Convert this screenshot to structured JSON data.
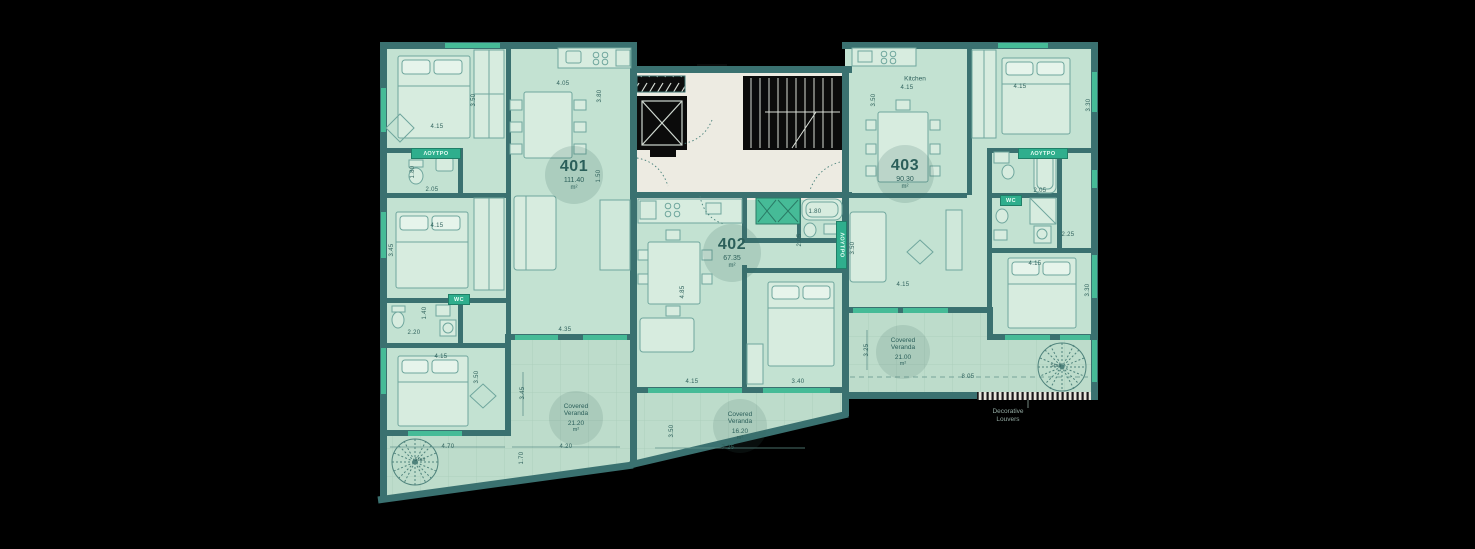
{
  "plan": {
    "units": [
      {
        "number": "401",
        "area": "111.40",
        "area_unit": "m²"
      },
      {
        "number": "402",
        "area": "67.35",
        "area_unit": "m²"
      },
      {
        "number": "403",
        "area": "90.30",
        "area_unit": "m²"
      }
    ],
    "verandas": [
      {
        "line1": "Covered",
        "line2": "Veranda",
        "area": "21.20",
        "area_unit": "m²"
      },
      {
        "line1": "Covered",
        "line2": "Veranda",
        "area": "16.20",
        "area_unit": "m²"
      },
      {
        "line1": "Covered",
        "line2": "Veranda",
        "area": "21.00",
        "area_unit": "m²"
      }
    ],
    "annotation": {
      "line1": "Decorative",
      "line2": "Louvers"
    },
    "room_labels": [
      {
        "text": "Kitchen",
        "x": 915,
        "y": 79
      }
    ],
    "stair_labels": [
      {
        "text": "Stair",
        "x": 420,
        "y": 460
      },
      {
        "text": "Stair",
        "x": 1056,
        "y": 366
      }
    ],
    "fixtures": [
      {
        "text": "ΛΟΥΤΡΟ",
        "x": 411,
        "y": 148,
        "w": 48,
        "h": 9,
        "vertical": false
      },
      {
        "text": "WC",
        "x": 448,
        "y": 294,
        "w": 20,
        "h": 9,
        "vertical": false
      },
      {
        "text": "ΛΟΥΤΡΟ",
        "x": 836,
        "y": 221,
        "w": 9,
        "h": 46,
        "vertical": true
      },
      {
        "text": "ΛΟΥΤΡΟ",
        "x": 1018,
        "y": 148,
        "w": 48,
        "h": 9,
        "vertical": false
      },
      {
        "text": "WC",
        "x": 1000,
        "y": 195,
        "w": 20,
        "h": 9,
        "vertical": false
      }
    ],
    "dimensions": [
      {
        "text": "4.15",
        "x": 437,
        "y": 127,
        "rot": 0
      },
      {
        "text": "3.50",
        "x": 474,
        "y": 100,
        "rot": 90
      },
      {
        "text": "1.80",
        "x": 413,
        "y": 172,
        "rot": 90
      },
      {
        "text": "2.05",
        "x": 432,
        "y": 190,
        "rot": 0
      },
      {
        "text": "4.15",
        "x": 437,
        "y": 226,
        "rot": 0
      },
      {
        "text": "3.45",
        "x": 392,
        "y": 250,
        "rot": 90
      },
      {
        "text": "1.40",
        "x": 425,
        "y": 313,
        "rot": 90
      },
      {
        "text": "2.20",
        "x": 414,
        "y": 333,
        "rot": 0
      },
      {
        "text": "4.15",
        "x": 441,
        "y": 357,
        "rot": 0
      },
      {
        "text": "3.50",
        "x": 477,
        "y": 377,
        "rot": 90
      },
      {
        "text": "4.05",
        "x": 563,
        "y": 84,
        "rot": 0
      },
      {
        "text": "3.80",
        "x": 600,
        "y": 96,
        "rot": 90
      },
      {
        "text": "4.35",
        "x": 565,
        "y": 330,
        "rot": 0
      },
      {
        "text": "1.50",
        "x": 599,
        "y": 176,
        "rot": 90
      },
      {
        "text": "3.45",
        "x": 523,
        "y": 393,
        "rot": 90
      },
      {
        "text": "4.20",
        "x": 566,
        "y": 447,
        "rot": 0
      },
      {
        "text": "1.70",
        "x": 522,
        "y": 458,
        "rot": 90
      },
      {
        "text": "4.70",
        "x": 448,
        "y": 447,
        "rot": 0
      },
      {
        "text": "4.15",
        "x": 692,
        "y": 382,
        "rot": 0
      },
      {
        "text": "3.40",
        "x": 798,
        "y": 382,
        "rot": 0
      },
      {
        "text": "7.25",
        "x": 728,
        "y": 448,
        "rot": 0
      },
      {
        "text": "3.50",
        "x": 672,
        "y": 431,
        "rot": 90
      },
      {
        "text": "4.85",
        "x": 683,
        "y": 292,
        "rot": 90
      },
      {
        "text": "1.80",
        "x": 815,
        "y": 212,
        "rot": 0
      },
      {
        "text": "2.05",
        "x": 800,
        "y": 240,
        "rot": 90
      },
      {
        "text": "4.15",
        "x": 907,
        "y": 88,
        "rot": 0
      },
      {
        "text": "3.50",
        "x": 874,
        "y": 100,
        "rot": 90
      },
      {
        "text": "4.15",
        "x": 1020,
        "y": 87,
        "rot": 0
      },
      {
        "text": "3.30",
        "x": 1089,
        "y": 105,
        "rot": 90
      },
      {
        "text": "2.05",
        "x": 1040,
        "y": 191,
        "rot": 0
      },
      {
        "text": "2.25",
        "x": 1068,
        "y": 235,
        "rot": 0
      },
      {
        "text": "4.15",
        "x": 1035,
        "y": 264,
        "rot": 0
      },
      {
        "text": "3.30",
        "x": 1088,
        "y": 290,
        "rot": 90
      },
      {
        "text": "3.50",
        "x": 853,
        "y": 248,
        "rot": 90
      },
      {
        "text": "4.15",
        "x": 903,
        "y": 285,
        "rot": 0
      },
      {
        "text": "3.25",
        "x": 867,
        "y": 350,
        "rot": 90
      },
      {
        "text": "8.05",
        "x": 968,
        "y": 377,
        "rot": 0
      }
    ]
  },
  "colors": {
    "wall": "#3a7170",
    "floor": "#c3e2d2",
    "veranda": "#bddccb",
    "accent": "#46bb97",
    "accent_dark": "#2fae8d",
    "corridor": "#edebe2",
    "ink": "#2f615c",
    "shaft": "#0b0b0b"
  }
}
